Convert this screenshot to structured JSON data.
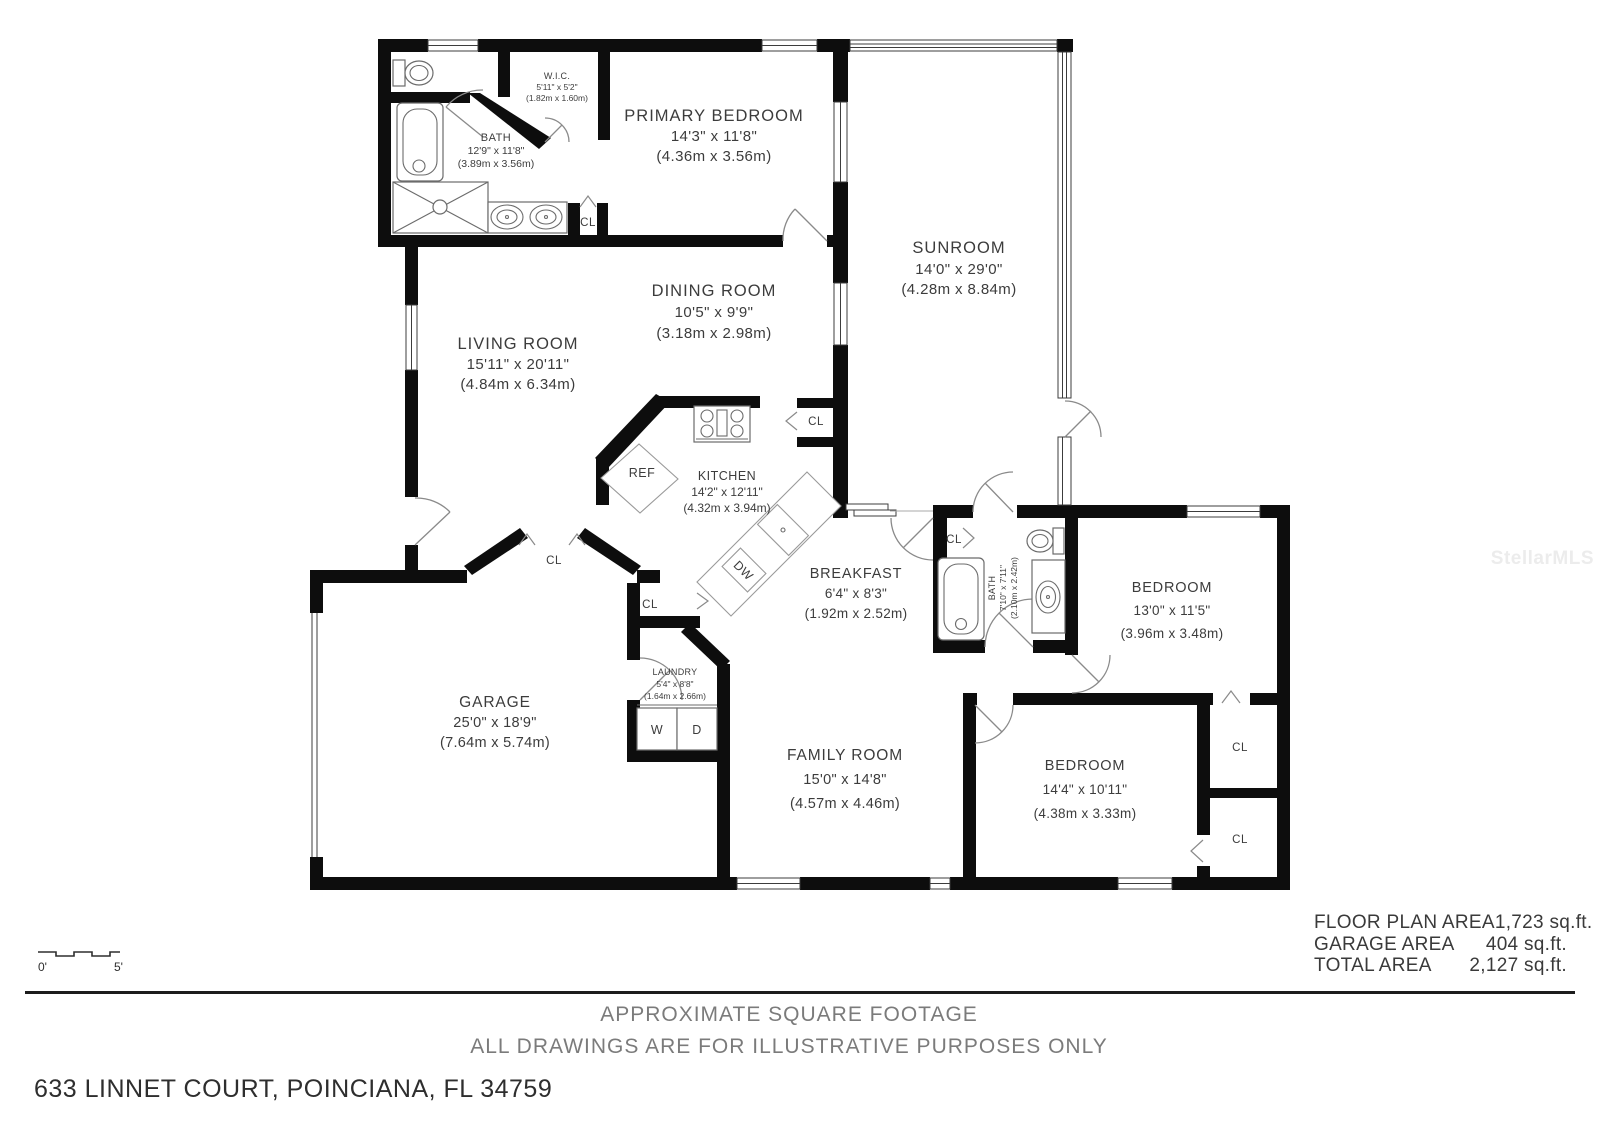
{
  "plan": {
    "rooms": {
      "primary_bedroom": {
        "name": "PRIMARY BEDROOM",
        "ft": "14'3\" x 11'8\"",
        "m": "(4.36m x 3.56m)"
      },
      "wic": {
        "name": "W.I.C.",
        "ft": "5'11\" x 5'2\"",
        "m": "(1.82m x 1.60m)"
      },
      "bath_primary": {
        "name": "BATH",
        "ft": "12'9\" x 11'8\"",
        "m": "(3.89m x 3.56m)"
      },
      "sunroom": {
        "name": "SUNROOM",
        "ft": "14'0\" x 29'0\"",
        "m": "(4.28m x 8.84m)"
      },
      "living_room": {
        "name": "LIVING ROOM",
        "ft": "15'11\" x 20'11\"",
        "m": "(4.84m x 6.34m)"
      },
      "dining_room": {
        "name": "DINING ROOM",
        "ft": "10'5\" x 9'9\"",
        "m": "(3.18m x 2.98m)"
      },
      "kitchen": {
        "name": "KITCHEN",
        "ft": "14'2\" x 12'11\"",
        "m": "(4.32m x 3.94m)"
      },
      "breakfast": {
        "name": "BREAKFAST",
        "ft": "6'4\" x 8'3\"",
        "m": "(1.92m x 2.52m)"
      },
      "bath_hall": {
        "name": "BATH",
        "ft": "7'10\" x 7'11\"",
        "m": "(2.10m x 2.42m)"
      },
      "bedroom_right": {
        "name": "BEDROOM",
        "ft": "13'0\" x 11'5\"",
        "m": "(3.96m x 3.48m)"
      },
      "bedroom_bottom": {
        "name": "BEDROOM",
        "ft": "14'4\" x 10'11\"",
        "m": "(4.38m x 3.33m)"
      },
      "garage": {
        "name": "GARAGE",
        "ft": "25'0\" x 18'9\"",
        "m": "(7.64m x 5.74m)"
      },
      "laundry": {
        "name": "LAUNDRY",
        "ft": "5'4\" x 8'8\"",
        "m": "(1.64m x 2.66m)"
      },
      "family_room": {
        "name": "FAMILY ROOM",
        "ft": "15'0\" x 14'8\"",
        "m": "(4.57m x 4.46m)"
      }
    },
    "fixtures": {
      "ref": "REF",
      "dw": "DW",
      "washer": "W",
      "dryer": "D",
      "closet": "CL"
    },
    "scale": {
      "zero": "0'",
      "five": "5'"
    }
  },
  "areas": {
    "rows": [
      {
        "label": "FLOOR PLAN AREA",
        "value": "1,723 sq.ft."
      },
      {
        "label": "GARAGE AREA",
        "value": "404 sq.ft."
      },
      {
        "label": "TOTAL AREA",
        "value": "2,127 sq.ft."
      }
    ]
  },
  "footer": {
    "line1": "APPROXIMATE SQUARE FOOTAGE",
    "line2": "ALL DRAWINGS ARE FOR ILLUSTRATIVE PURPOSES ONLY",
    "address": "633 LINNET COURT, POINCIANA, FL 34759"
  },
  "watermark": "StellarMLS"
}
